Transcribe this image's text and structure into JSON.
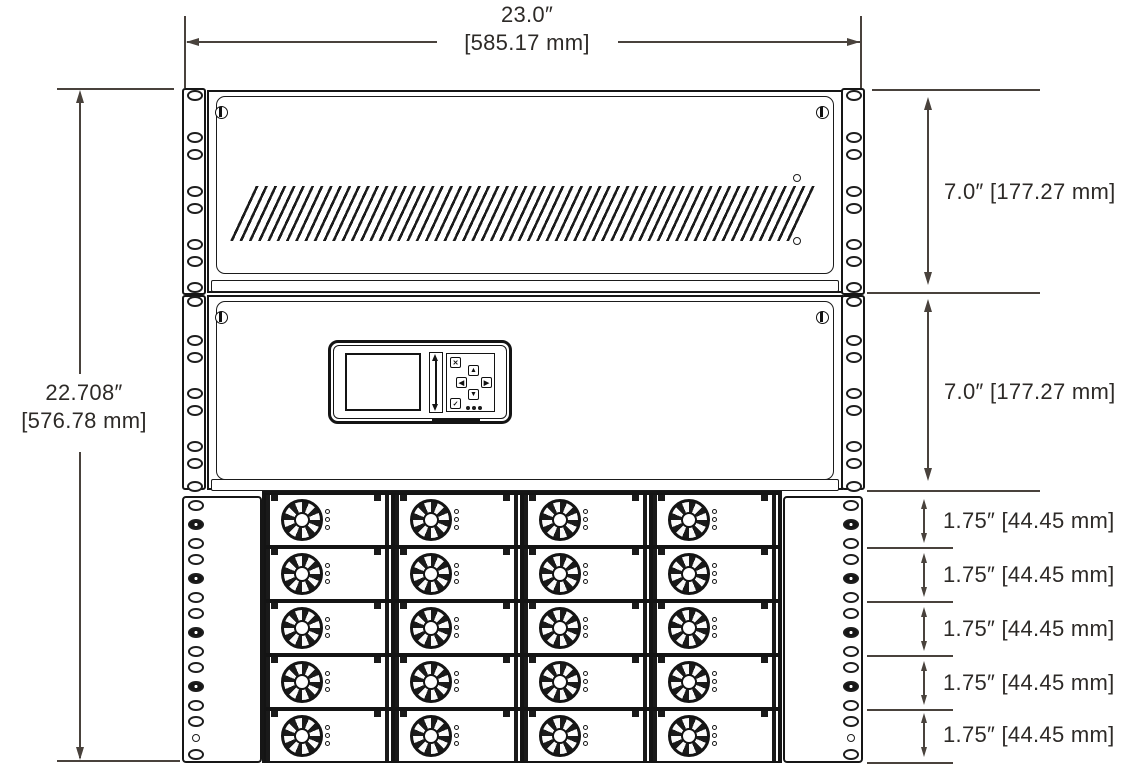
{
  "drawing": {
    "dim_overall_width_in": "23.0″",
    "dim_overall_width_mm": "[585.17 mm]",
    "dim_overall_height_in": "22.708″",
    "dim_overall_height_mm": "[576.78 mm]",
    "dim_top_shelf": "7.0″ [177.27 mm]",
    "dim_middle_shelf": "7.0″ [177.27 mm]",
    "dim_unit_rows": [
      "1.75″ [44.45 mm]",
      "1.75″ [44.45 mm]",
      "1.75″ [44.45 mm]",
      "1.75″ [44.45 mm]",
      "1.75″ [44.45 mm]"
    ]
  },
  "keypad_icons": {
    "cancel": "✕",
    "confirm": "✓",
    "arrow_up": "▲",
    "arrow_down": "▼",
    "arrow_left": "◀",
    "arrow_right": "▶"
  },
  "module_grid": {
    "rows": 5,
    "cols": 4,
    "leds_per_module": 3
  },
  "colors": {
    "line": "#161616",
    "dimension": "#49423c",
    "text": "#2d2a27",
    "background": "#ffffff"
  }
}
